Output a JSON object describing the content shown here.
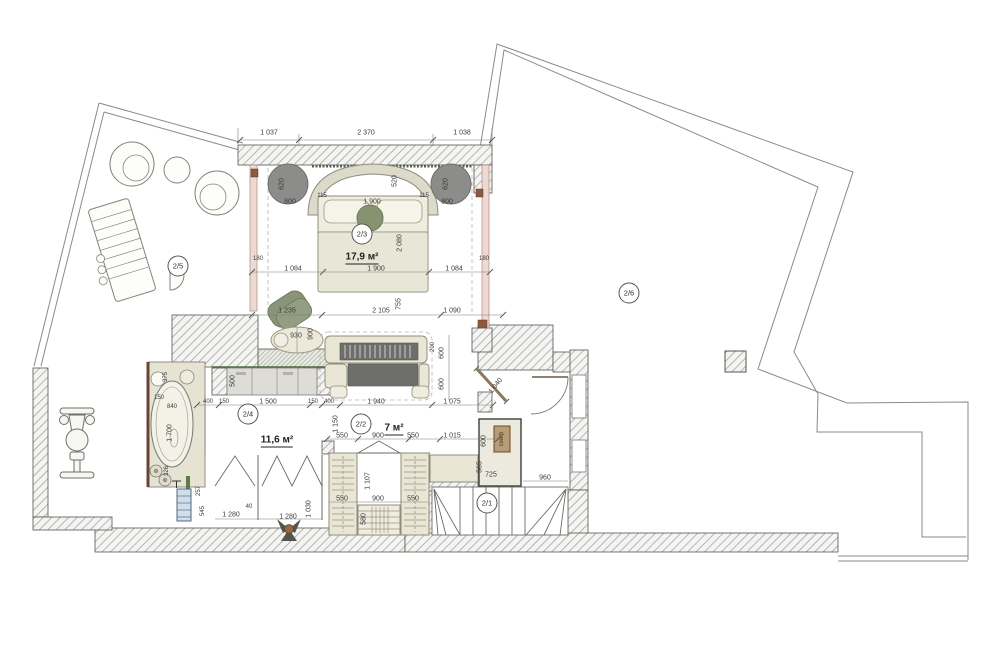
{
  "plan": {
    "title": "apartment-floor-plan-level-2",
    "room_tags": [
      {
        "id": "2/3",
        "x": 362,
        "y": 234,
        "area": "17,9 м²",
        "area_x": 362,
        "area_y": 258
      },
      {
        "id": "2/5",
        "x": 178,
        "y": 266
      },
      {
        "id": "2/6",
        "x": 629,
        "y": 293
      },
      {
        "id": "2/4",
        "x": 248,
        "y": 414,
        "area": "11,6 м²",
        "area_x": 277,
        "area_y": 441
      },
      {
        "id": "2/2",
        "x": 361,
        "y": 424,
        "area": "7 м²",
        "area_x": 394,
        "area_y": 429
      },
      {
        "id": "2/1",
        "x": 487,
        "y": 503
      }
    ],
    "dimensions": [
      {
        "t": "1 037",
        "x": 269,
        "y": 133
      },
      {
        "t": "2 370",
        "x": 366,
        "y": 133
      },
      {
        "t": "1 038",
        "x": 462,
        "y": 133
      },
      {
        "t": "620",
        "x": 282,
        "y": 184,
        "r": -90
      },
      {
        "t": "800",
        "x": 290,
        "y": 202
      },
      {
        "t": "620",
        "x": 446,
        "y": 184,
        "r": -90
      },
      {
        "t": "800",
        "x": 447,
        "y": 202
      },
      {
        "t": "115",
        "x": 322,
        "y": 196,
        "s": 6
      },
      {
        "t": "115",
        "x": 424,
        "y": 196,
        "s": 6
      },
      {
        "t": "1 900",
        "x": 372,
        "y": 202
      },
      {
        "t": "520",
        "x": 395,
        "y": 181,
        "r": -90
      },
      {
        "t": "2 080",
        "x": 400,
        "y": 243,
        "r": -90
      },
      {
        "t": "180",
        "x": 258,
        "y": 259,
        "s": 6
      },
      {
        "t": "1 084",
        "x": 293,
        "y": 269
      },
      {
        "t": "1 900",
        "x": 376,
        "y": 269
      },
      {
        "t": "1 084",
        "x": 454,
        "y": 269
      },
      {
        "t": "180",
        "x": 484,
        "y": 259,
        "s": 6
      },
      {
        "t": "1 235",
        "x": 287,
        "y": 311
      },
      {
        "t": "2 105",
        "x": 381,
        "y": 311
      },
      {
        "t": "755",
        "x": 399,
        "y": 304,
        "r": -90
      },
      {
        "t": "1 090",
        "x": 452,
        "y": 311
      },
      {
        "t": "930",
        "x": 296,
        "y": 336
      },
      {
        "t": "900",
        "x": 311,
        "y": 334,
        "r": -90
      },
      {
        "t": "200",
        "x": 433,
        "y": 347,
        "r": -90,
        "s": 6
      },
      {
        "t": "600",
        "x": 442,
        "y": 353,
        "r": -90
      },
      {
        "t": "600",
        "x": 442,
        "y": 384,
        "r": -90
      },
      {
        "t": "1 940",
        "x": 376,
        "y": 402
      },
      {
        "t": "1 075",
        "x": 452,
        "y": 402
      },
      {
        "t": "1 150",
        "x": 336,
        "y": 424,
        "r": -90
      },
      {
        "t": "550",
        "x": 342,
        "y": 436
      },
      {
        "t": "900",
        "x": 378,
        "y": 436
      },
      {
        "t": "550",
        "x": 413,
        "y": 436
      },
      {
        "t": "1 015",
        "x": 452,
        "y": 436
      },
      {
        "t": "1 107",
        "x": 368,
        "y": 481,
        "r": -90
      },
      {
        "t": "550",
        "x": 342,
        "y": 499
      },
      {
        "t": "900",
        "x": 378,
        "y": 499
      },
      {
        "t": "550",
        "x": 413,
        "y": 499
      },
      {
        "t": "580",
        "x": 364,
        "y": 519,
        "r": -90
      },
      {
        "t": "500",
        "x": 233,
        "y": 381,
        "r": -90
      },
      {
        "t": "400",
        "x": 208,
        "y": 402,
        "s": 6
      },
      {
        "t": "150",
        "x": 224,
        "y": 402,
        "s": 6
      },
      {
        "t": "1 500",
        "x": 268,
        "y": 402
      },
      {
        "t": "150",
        "x": 313,
        "y": 402,
        "s": 6
      },
      {
        "t": "400",
        "x": 329,
        "y": 402,
        "s": 6
      },
      {
        "t": "375",
        "x": 166,
        "y": 377,
        "r": -90,
        "s": 6
      },
      {
        "t": "150",
        "x": 159,
        "y": 398,
        "s": 6
      },
      {
        "t": "840",
        "x": 172,
        "y": 407,
        "s": 6
      },
      {
        "t": "1 700",
        "x": 170,
        "y": 433,
        "r": -90
      },
      {
        "t": "326",
        "x": 167,
        "y": 471,
        "r": -90,
        "s": 6
      },
      {
        "t": "257",
        "x": 199,
        "y": 491,
        "r": -90,
        "s": 6
      },
      {
        "t": "545",
        "x": 203,
        "y": 511,
        "r": -90,
        "s": 6
      },
      {
        "t": "1 280",
        "x": 231,
        "y": 515
      },
      {
        "t": "40",
        "x": 249,
        "y": 507,
        "s": 6
      },
      {
        "t": "1 280",
        "x": 288,
        "y": 517
      },
      {
        "t": "1 030",
        "x": 309,
        "y": 509,
        "r": -90
      },
      {
        "t": "1 040",
        "x": 496,
        "y": 386,
        "r": -52
      },
      {
        "t": "600",
        "x": 484,
        "y": 441,
        "r": -90
      },
      {
        "t": "565",
        "x": 480,
        "y": 467,
        "r": -90
      },
      {
        "t": "725",
        "x": 491,
        "y": 475
      },
      {
        "t": "960",
        "x": 545,
        "y": 478
      }
    ],
    "annotations": [
      {
        "t": "сейф",
        "x": 502,
        "y": 439,
        "r": -90
      }
    ],
    "palette": {
      "wall_hatch_line": "#9a9a98",
      "wall_stroke": "#55554f",
      "furniture_beige": "#e9e6d6",
      "pouf_dark_gray": "#8c8c8a",
      "accent_green": "#87936f",
      "threshold_green": "#4e6b3e",
      "wood_brown": "#8b5a3c",
      "safe_brown": "#b79c77",
      "window_pink": "#ecd9d4",
      "radiator_blue": "#cfe0ec",
      "dim_text": "#3a3a3a"
    }
  }
}
